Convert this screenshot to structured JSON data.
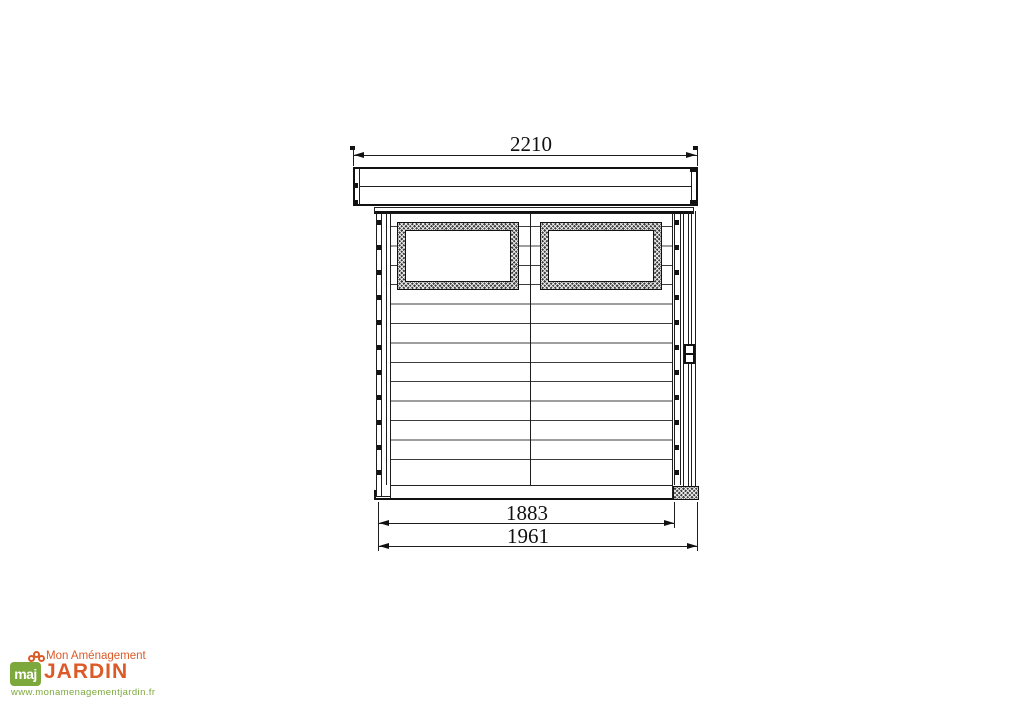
{
  "drawing": {
    "description": "shed-front-elevation",
    "dimensions": {
      "overall_width_mm": "2210",
      "wall_width_mm": "1883",
      "base_width_mm": "1961"
    }
  },
  "logo": {
    "monogram": "maj",
    "name_line1": "Mon Aménagement",
    "name_line2": "JARDIN",
    "website": "www.monamenagementjardin.fr",
    "colors": {
      "green": "#7CA83C",
      "orange": "#DC5A28"
    }
  }
}
